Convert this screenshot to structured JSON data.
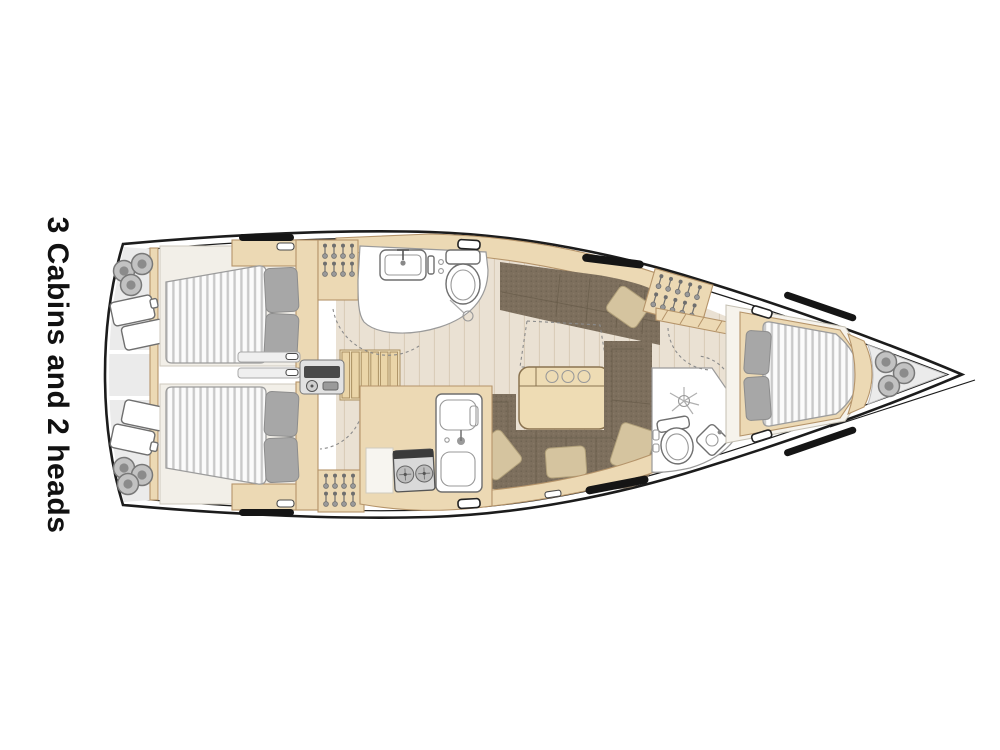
{
  "label": {
    "text": "3 Cabins and 2 heads"
  },
  "colors": {
    "hull_line": "#1c1c1c",
    "wood": "#ecd9b4",
    "wood_edge": "#b5946a",
    "floor": "#eae1d3",
    "plank": "#d8cbb6",
    "deck_gray": "#ebebeb",
    "room_white": "#ffffff",
    "mattress": "#fbfbfb",
    "mattress_stripe": "#c9c9c9",
    "pillow_gray": "#a7a7a7",
    "pillow_beige": "#d5c49f",
    "settee": "#7d6f5d",
    "settee_line": "#675b4a",
    "window_black": "#151515"
  },
  "features": [
    "aft-port-cabin-double-bed",
    "aft-starboard-cabin-double-bed",
    "forward-cabin-double-bed",
    "aft-head-toilet",
    "aft-head-sink",
    "aft-head-shower",
    "forward-head-toilet",
    "forward-head-sink",
    "forward-head-shower",
    "galley-stove",
    "galley-double-sink",
    "salon-folding-table",
    "bottle-holder",
    "port-settee",
    "starboard-settee",
    "nav-chart",
    "companionway-steps",
    "electrical-panel",
    "hanging-lockers",
    "fenders",
    "stern-cushions",
    "deck-hatches",
    "hull-windows"
  ]
}
